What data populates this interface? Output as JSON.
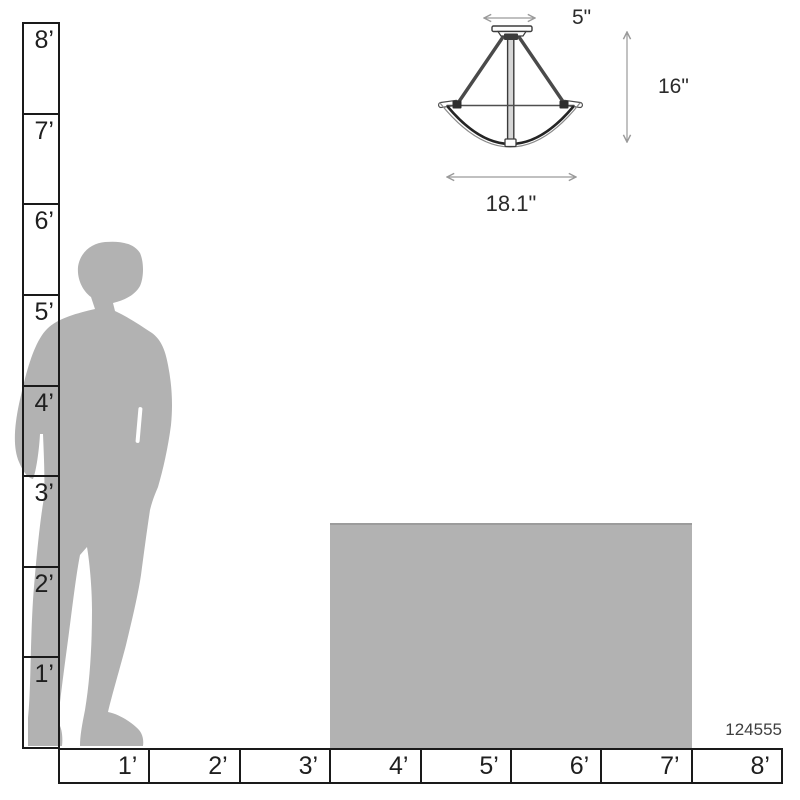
{
  "product": {
    "code": "124555"
  },
  "dimensions": {
    "canopy_width": "5\"",
    "fixture_height": "16\"",
    "fixture_width": "18.1\""
  },
  "rulers": {
    "vertical_feet": {
      "labels": [
        "8’",
        "7’",
        "6’",
        "5’",
        "4’",
        "3’",
        "2’",
        "1’"
      ]
    },
    "horizontal_feet": {
      "labels": [
        "1’",
        "2’",
        "3’",
        "4’",
        "5’",
        "6’",
        "7’",
        "8’"
      ]
    }
  },
  "colors": {
    "silhouette_gray": "#b2b2b2",
    "table_gray": "#b2b2b2",
    "ruler_line": "#1a1a1a",
    "dimension_line": "#9a9a9a",
    "fixture_line": "#3c3c3c"
  }
}
